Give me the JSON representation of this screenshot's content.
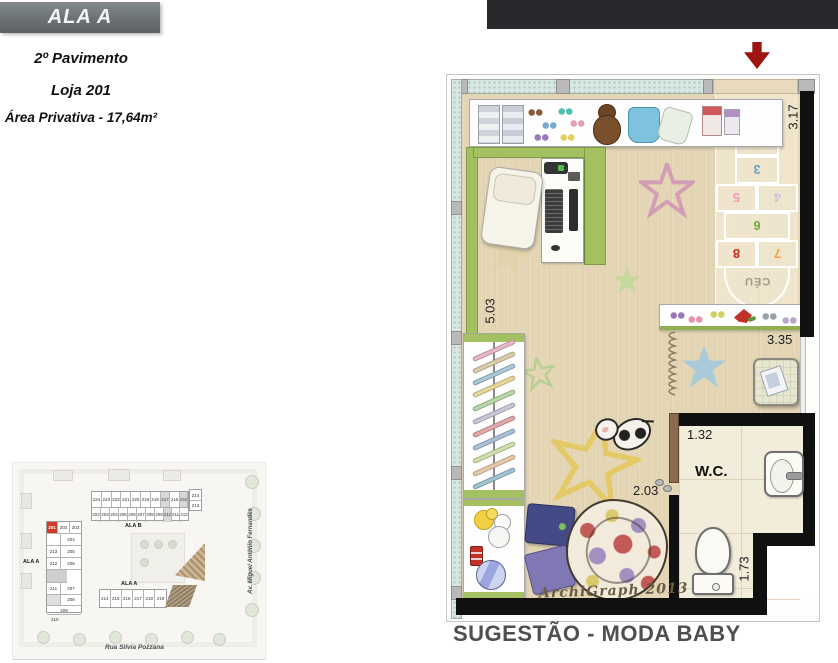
{
  "header": {
    "wing_label": "ALA A",
    "floor": "2º Pavimento",
    "unit": "Loja 201",
    "area": "Área Privativa - 17,64m²"
  },
  "plan": {
    "caption": "SUGESTÃO - MODA BABY",
    "signature": "ArchiGraph 2013",
    "wc_label": "W.C.",
    "dimensions": {
      "top_right": "3.17",
      "left_wall": "5.03",
      "shelf_wall": "3.35",
      "wc_width": "1.32",
      "wc_door": "2.03",
      "wc_depth": "1.73"
    },
    "hopscotch": {
      "sky": "CÉU",
      "cells": [
        {
          "label": "1",
          "color": "#dd8a2e"
        },
        {
          "label": "2",
          "color": "#e3c32e"
        },
        {
          "label": "3",
          "color": "#6fa3c7"
        },
        {
          "label": "5",
          "color": "#ef9ab8"
        },
        {
          "label": "4",
          "color": "#cfc3dc"
        },
        {
          "label": "6",
          "color": "#6cae3e"
        },
        {
          "label": "8",
          "color": "#c9291a"
        },
        {
          "label": "7",
          "color": "#eda23e"
        }
      ]
    }
  },
  "siteplan": {
    "left_wing": {
      "label": "ALA A",
      "highlighted_unit": "201",
      "row_top": [
        "201",
        "202",
        "203"
      ],
      "rows": [
        {
          "left": "",
          "right": "204"
        },
        {
          "left": "213",
          "right": "205"
        },
        {
          "left": "212",
          "right": "206"
        },
        {
          "left": "211",
          "right": "207"
        },
        {
          "left": "",
          "right": "208"
        }
      ],
      "row_209": "209",
      "row_210": "210"
    },
    "top_wing": {
      "label": "ALA B",
      "row_top": [
        "224",
        "223",
        "222",
        "221",
        "220",
        "219",
        "218",
        "217",
        "216",
        "215"
      ],
      "row_bottom": [
        "202",
        "203",
        "204",
        "205",
        "206",
        "207",
        "208",
        "209",
        "210",
        "211",
        "212"
      ],
      "annex": [
        "214",
        "213"
      ]
    },
    "bottom_wing": {
      "label": "ALA A",
      "units": [
        "214",
        "215",
        "216",
        "217",
        "218",
        "219"
      ]
    },
    "streets": {
      "bottom": "Rua Silvia Pozzana",
      "right": "Av. Miguel Antônio Fernandes"
    }
  },
  "colors": {
    "arrow_red": "#9d1410",
    "header_gray": "#6b7174",
    "top_bar": "#27292c",
    "caption_gray": "#4f4f4f",
    "highlight_red": "#d13a28",
    "wall_green": "#a3c161",
    "wall_teal": "#d9e7e2",
    "floor_wood": "#e4d6b4"
  }
}
